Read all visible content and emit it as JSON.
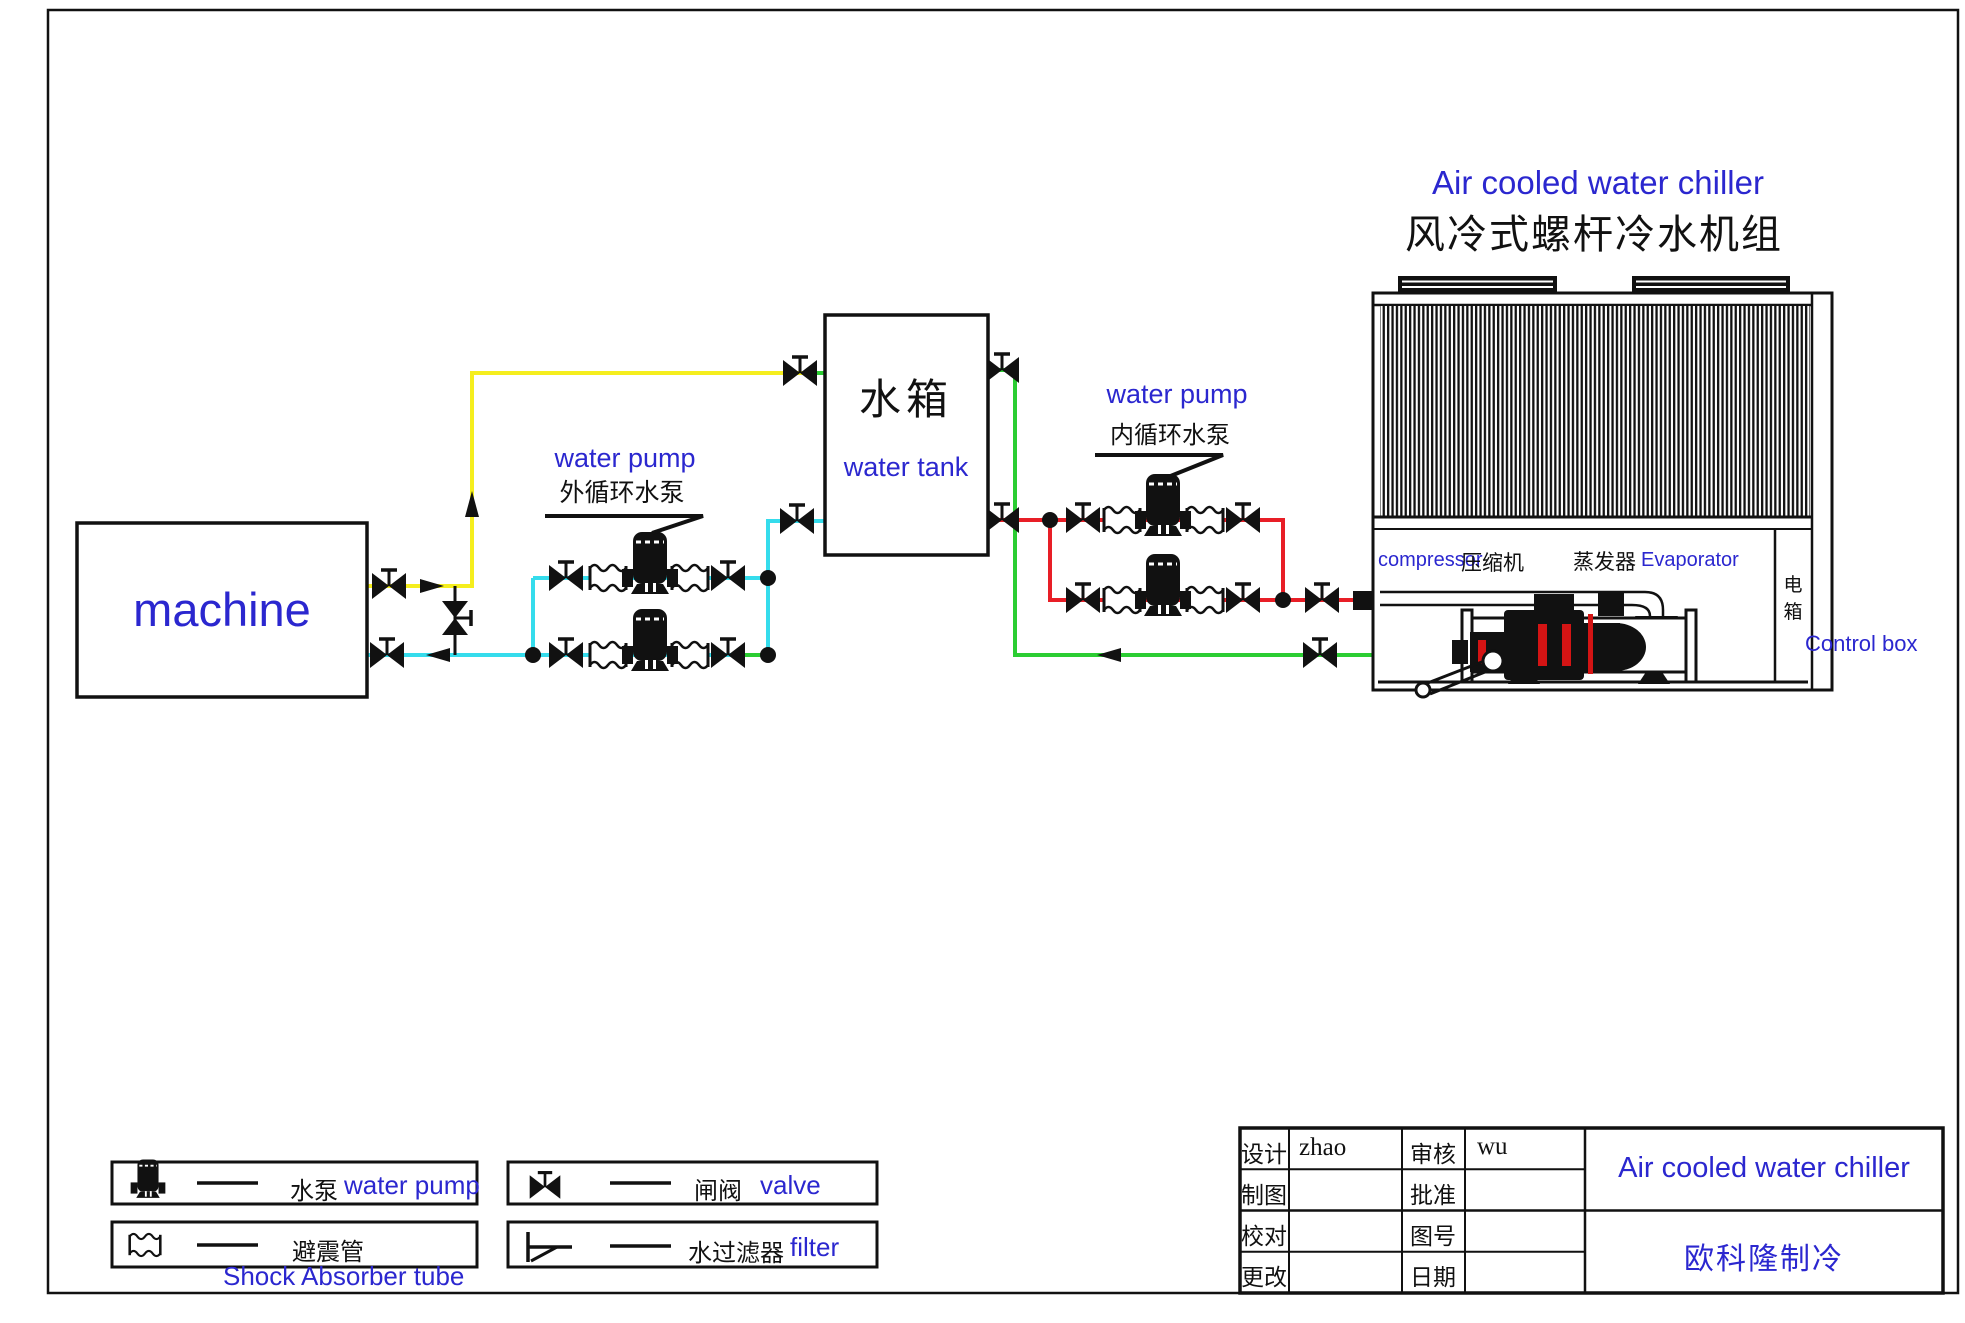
{
  "title": {
    "en": "Air cooled water chiller",
    "zh": "风冷式螺杆冷水机组"
  },
  "machine": {
    "label": "machine"
  },
  "water_tank": {
    "zh": "水箱",
    "en": "water tank"
  },
  "external_pump_label": {
    "en": "water pump",
    "zh": "外循环水泵"
  },
  "internal_pump_label": {
    "en": "water pump",
    "zh": "内循环水泵"
  },
  "chiller": {
    "compressor_en": "compressor",
    "compressor_zh": "压缩机",
    "evaporator_zh": "蒸发器",
    "evaporator_en": "Evaporator",
    "control_box_zh": "电箱",
    "control_box_en": "Control box"
  },
  "legend": {
    "pump_zh": "水泵",
    "pump_en": "water pump",
    "shock_zh": "避震管",
    "shock_en": "Shock Absorber tube",
    "valve_zh": "闸阀",
    "valve_en": "valve",
    "filter_zh": "水过滤器",
    "filter_en": "filter"
  },
  "title_block": {
    "design_label": "设计",
    "design_value": "zhao",
    "review_label": "审核",
    "review_value": "wu",
    "draft_label": "制图",
    "approve_label": "批准",
    "proof_label": "校对",
    "drawing_no_label": "图号",
    "revise_label": "更改",
    "date_label": "日期",
    "product": "Air cooled water chiller",
    "company": "欧科隆制冷"
  },
  "colors": {
    "label_blue": "#2b27cf",
    "pipe_yellow": "#f5ee1e",
    "pipe_cyan": "#35dcec",
    "pipe_red": "#e81e26",
    "pipe_green": "#2bcd32",
    "line_black": "#111111",
    "compressor_red": "#d41414"
  }
}
